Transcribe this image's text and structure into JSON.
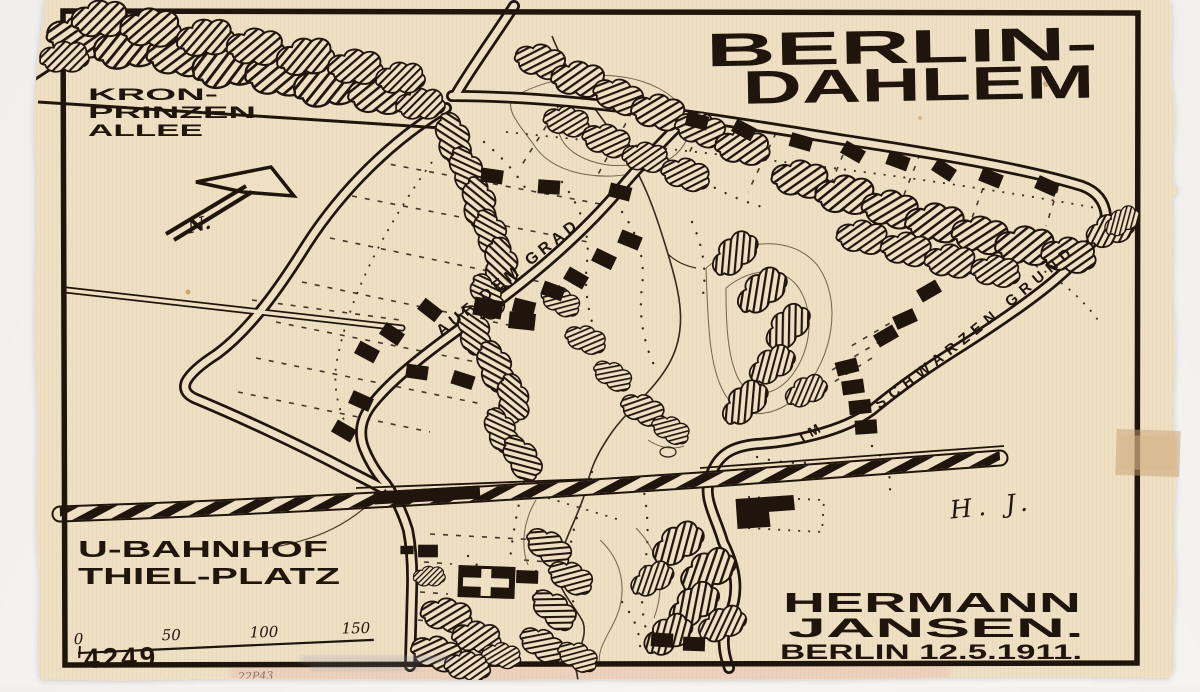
{
  "title": {
    "line1": "BERLIN-",
    "line2": "DAHLEM"
  },
  "labels": {
    "kronprinzen": [
      "KRON-",
      "PRINZEN",
      "ALLEE"
    ],
    "auf_dem_grad": "AUF DEM GRAD",
    "im": "IM",
    "schwarzen_grund": "SCHWARZEN GRUND",
    "u_bahnhof": [
      "U-BAHNHOF",
      "THIEL-PLATZ"
    ],
    "north": "N."
  },
  "credit": {
    "name_line1": "HERMANN",
    "name_line2": "JANSEN.",
    "place_date": "BERLIN 12.5.1911.",
    "signature": "H. J."
  },
  "plan_number": "4249",
  "scale_bar": {
    "ticks": [
      "0",
      "50",
      "100",
      "150"
    ]
  },
  "pencil_note": "22P43",
  "colors": {
    "paper": "#efe0c3",
    "ink": "#20150d",
    "background": "#f6f5f3",
    "tape": "#c9a06f"
  }
}
